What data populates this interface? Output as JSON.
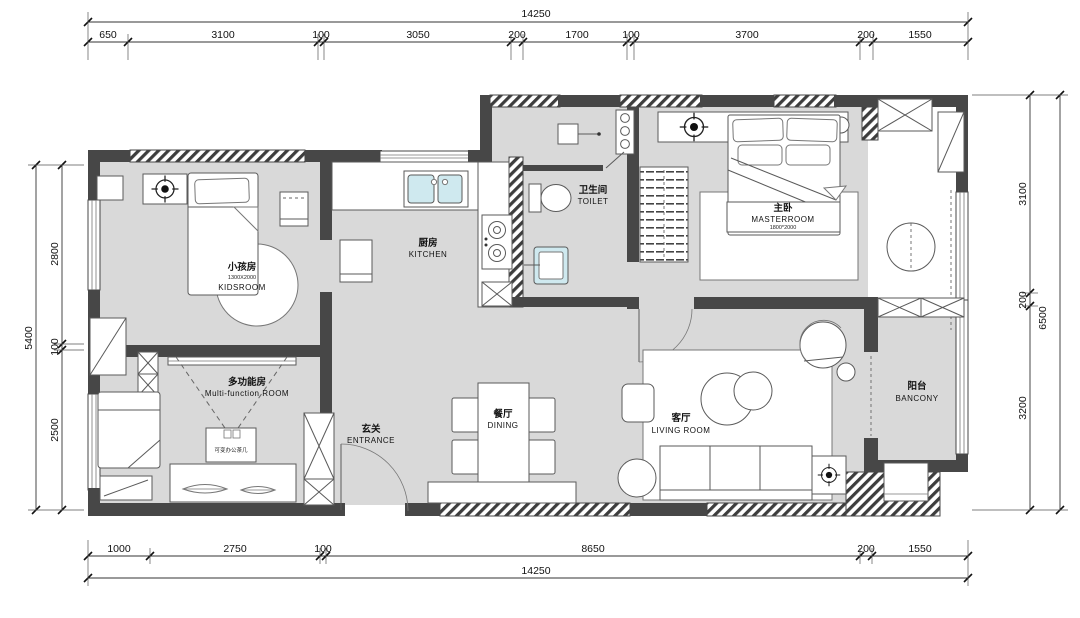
{
  "dimensions": {
    "top": {
      "overall": "14250",
      "segments": [
        "650",
        "3100",
        "100",
        "3050",
        "200",
        "1700",
        "100",
        "3700",
        "200",
        "1550"
      ]
    },
    "bottom": {
      "overall": "14250",
      "segments": [
        "1000",
        "2750",
        "100",
        "8650",
        "200",
        "1550"
      ]
    },
    "left": {
      "overall": "5400",
      "segments": [
        "2800",
        "100",
        "2500"
      ]
    },
    "right": {
      "overall": "6500",
      "segments": [
        "3100",
        "200",
        "3200"
      ]
    }
  },
  "rooms": {
    "kids": {
      "name_zh": "小孩房",
      "bed_size": "1300X2000",
      "name_en": "KIDSROOM"
    },
    "kitchen": {
      "name_zh": "厨房",
      "name_en": "KITCHEN"
    },
    "toilet": {
      "name_zh": "卫生间",
      "name_en": "TOILET"
    },
    "master": {
      "name_zh": "主卧",
      "name_en": "MASTERROOM",
      "bed_size": "1800*2000"
    },
    "multi": {
      "name_zh": "多功能房",
      "name_en": "Multi-function ROOM",
      "table_label": "可变办公茶几"
    },
    "entrance": {
      "name_zh": "玄关",
      "name_en": "ENTRANCE"
    },
    "dining": {
      "name_zh": "餐厅",
      "name_en": "DINING"
    },
    "living": {
      "name_zh": "客厅",
      "name_en": "LIVING ROOM"
    },
    "balcony": {
      "name_zh": "阳台",
      "name_en": "BANCONY"
    }
  },
  "colors": {
    "wall": "#474747",
    "floor": "#d9d9d9",
    "fixture_blue": "#cfe9ef"
  }
}
